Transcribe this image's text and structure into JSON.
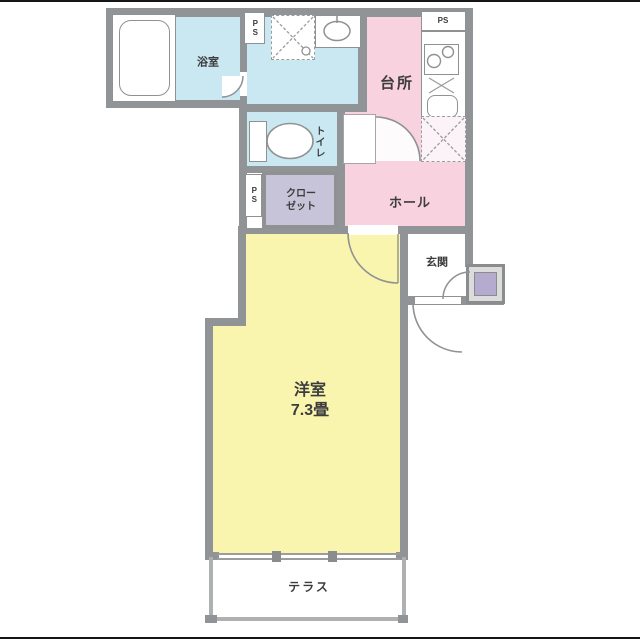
{
  "meta": {
    "type": "japanese-apartment-floor-plan",
    "room_size_total": "7.3畳"
  },
  "colors": {
    "wet_area_cyan": "#c9e8f2",
    "kitchen_hall_pink": "#f8d2de",
    "main_room_yellow": "#faf5ae",
    "closet_lavender": "#c7c3d8",
    "wall_gray": "#919496",
    "meter_box_purple": "#b5abce",
    "text": "#3c3c3e"
  },
  "rooms": {
    "bathroom": {
      "label": "浴室"
    },
    "kitchen": {
      "label": "台所"
    },
    "toilet": {
      "label": "トイレ"
    },
    "closet": {
      "label_line1": "クロー",
      "label_line2": "ゼット"
    },
    "hall": {
      "label": "ホール"
    },
    "entrance": {
      "label": "玄関"
    },
    "western_room": {
      "label_line1": "洋室",
      "label_line2": "7.3畳"
    },
    "terrace": {
      "label": "テラス"
    }
  },
  "utilities": {
    "ps_top_left": {
      "label": "PS"
    },
    "ps_kitchen": {
      "label": "PS"
    },
    "ps_closet": {
      "label": "PS"
    }
  },
  "fixtures": {
    "bathtub": "bathtub",
    "washing_machine_pan": "washing-machine-pan",
    "washbasin": "washbasin",
    "stove": "two-burner-stove",
    "kitchen_sink": "kitchen-sink",
    "refrigerator_space": "refrigerator-space",
    "toilet_fixture": "toilet",
    "meter_box": "meter-box"
  }
}
